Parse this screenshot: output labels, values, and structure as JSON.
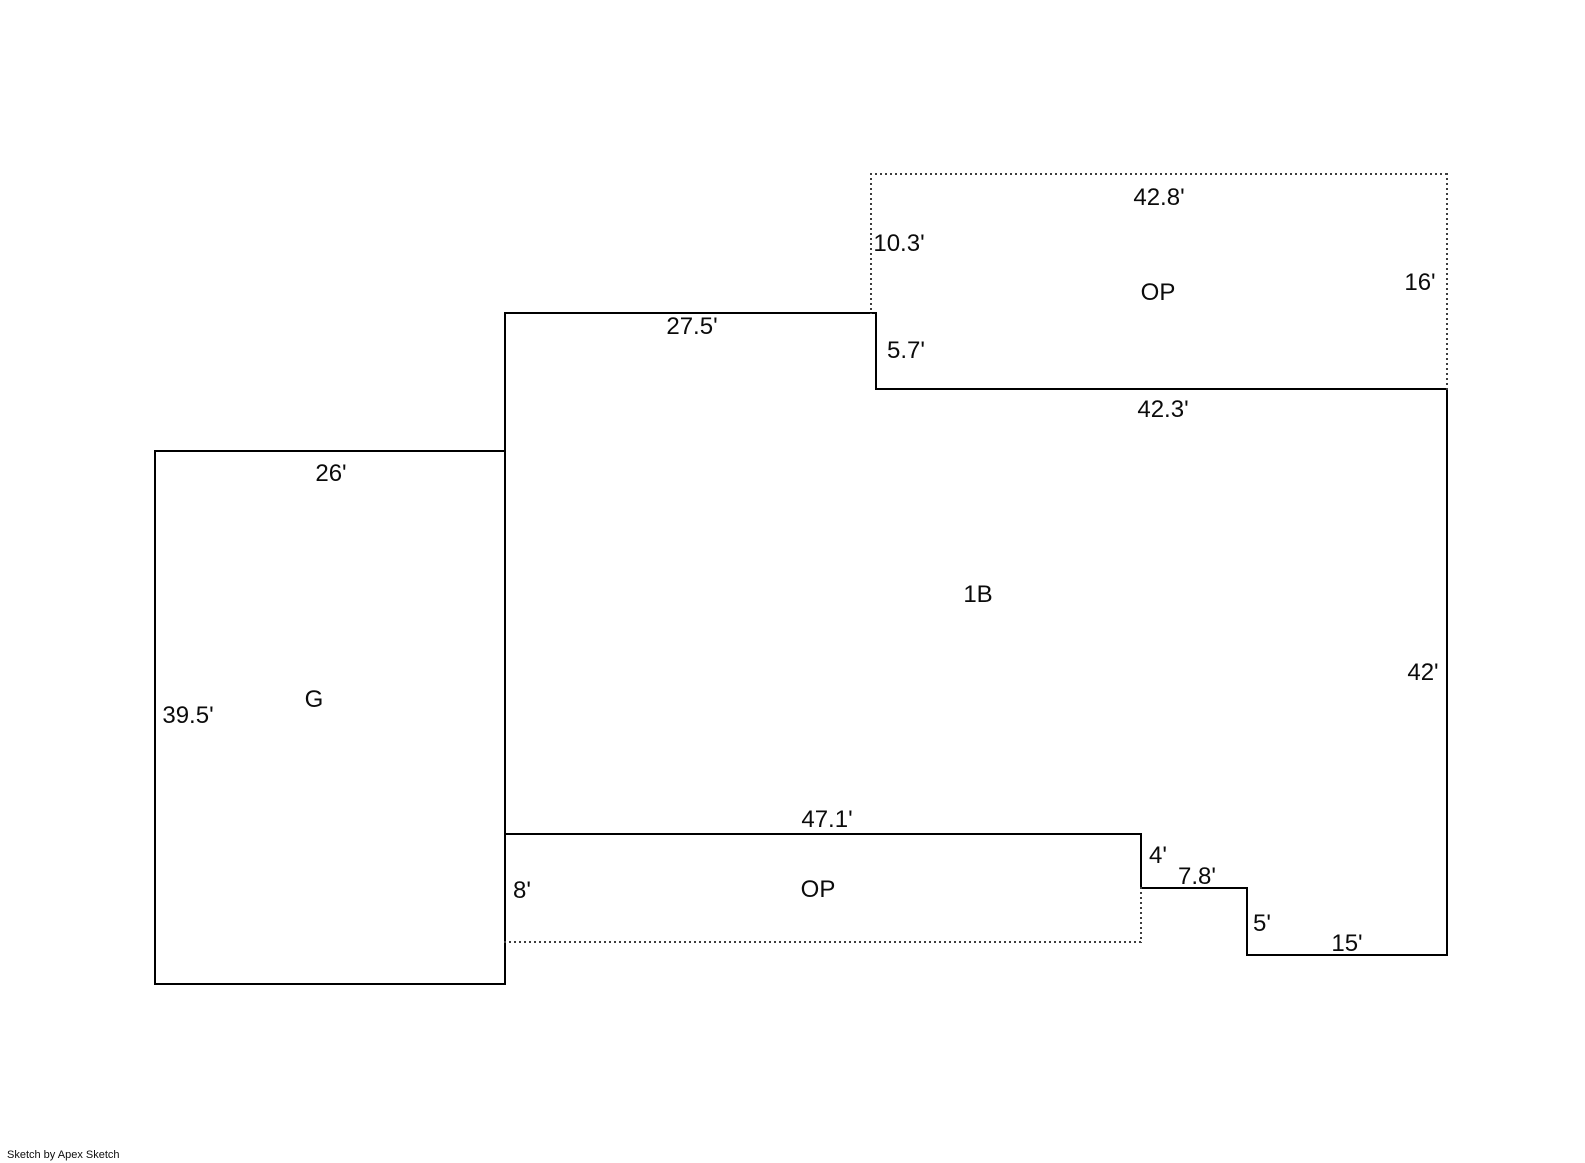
{
  "page": {
    "footer_credit": "Sketch by Apex Sketch"
  },
  "regions": {
    "garage_label": "G",
    "first_story_label": "1B",
    "open_porch_upper_label": "OP",
    "open_porch_lower_label": "OP"
  },
  "dimensions": {
    "porch_upper_top": "42.8'",
    "porch_upper_left": "10.3'",
    "porch_upper_right": "16'",
    "first_story_top": "27.5'",
    "first_story_right_jog": "5.7'",
    "first_story_upper_right": "42.3'",
    "garage_top": "26'",
    "garage_left": "39.5'",
    "first_story_right": "42'",
    "porch_lower_top": "47.1'",
    "porch_lower_left": "8'",
    "step_down_4": "4'",
    "step_right_7_8": "7.8'",
    "step_down_5": "5'",
    "bottom_right": "15'"
  },
  "colors": {
    "background": "#ffffff",
    "solid_line": "#000000",
    "dotted_line": "#3d3d3d",
    "text": "#0b0b0b"
  }
}
